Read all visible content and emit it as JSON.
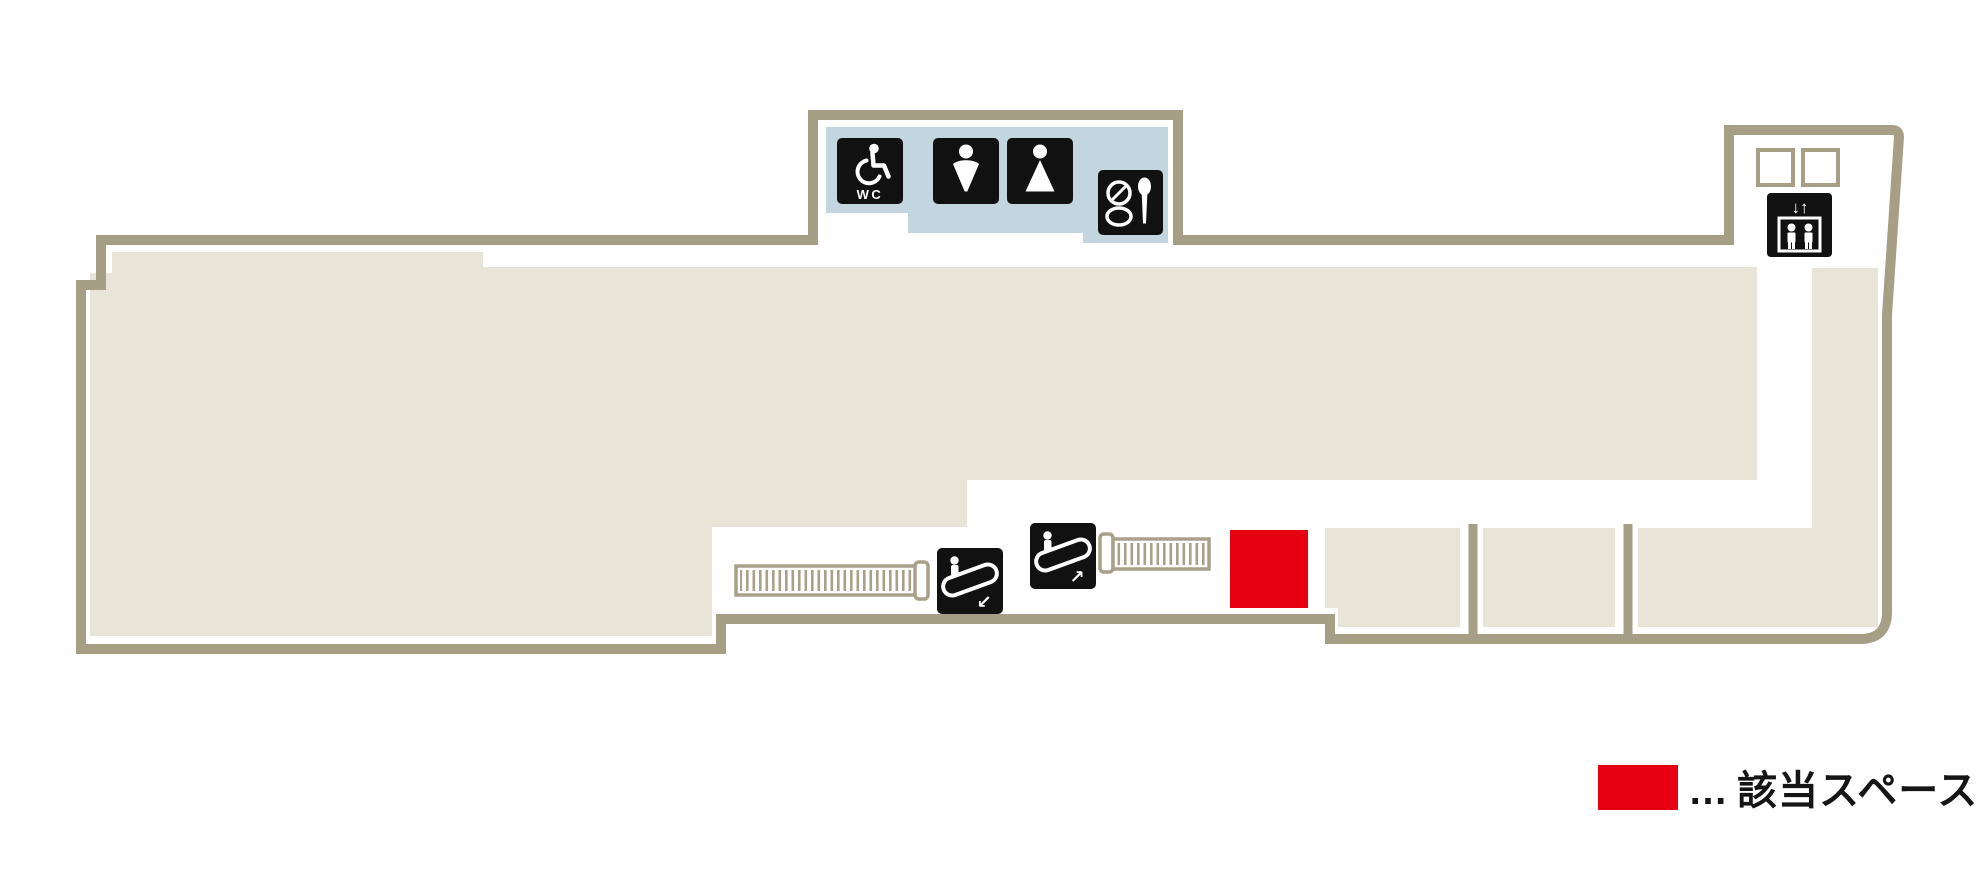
{
  "map": {
    "type": "department-store-floor-map",
    "areas": {
      "main_floor": "sales floor",
      "restroom_block": "restroom area (top center)",
      "elevator_lobby": "elevator area (top right)",
      "tenant_compartments": "three spaces (bottom right)",
      "highlighted_space": "該当スペース"
    }
  },
  "facilities": {
    "wheelchair_wc": {
      "name": "accessible toilet",
      "label": "WC"
    },
    "mens_restroom": {
      "name": "men's restroom"
    },
    "womens_restroom": {
      "name": "women's restroom"
    },
    "powder_room": {
      "name": "powder room"
    },
    "elevator": {
      "name": "elevator",
      "arrows": "↓↑"
    },
    "escalator_up": {
      "name": "escalator up",
      "arrow": "↗"
    },
    "escalator_down": {
      "name": "escalator down",
      "arrow": "↙"
    },
    "stairs_left": {
      "name": "stairs / escalator run (left)"
    },
    "stairs_right": {
      "name": "stairs / escalator run (right)"
    }
  },
  "legend": {
    "dots": "…",
    "label": "該当スペース"
  },
  "colors": {
    "wall": "#a79e86",
    "floor": "#e8e4d8",
    "restroom_area": "#c3d6e0",
    "highlight_red": "#e60012",
    "icon_black": "#111111",
    "stairs_outline": "#a9a089",
    "legend_text": "#151515",
    "background": "#ffffff"
  }
}
